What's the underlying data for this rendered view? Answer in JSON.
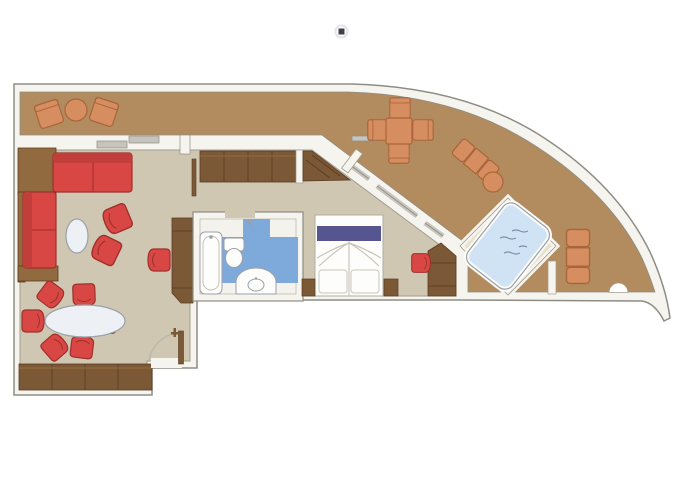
{
  "plan": {
    "kind": "suite-floor-plan",
    "rooms": [
      "balcony-deck",
      "living-room",
      "dining-area",
      "corridor",
      "bathroom",
      "bedroom",
      "whirlpool-deck"
    ],
    "items": [
      "sectional-sofa",
      "coffee-table",
      "armchair",
      "dining-table",
      "dining-chair",
      "sideboard",
      "tv-cabinet",
      "wardrobe-closet",
      "bathtub",
      "toilet",
      "sink-vanity",
      "shower-head",
      "double-bed",
      "nightstand",
      "desk",
      "desk-chair",
      "deck-chair",
      "deck-table",
      "sun-lounger",
      "side-table",
      "whirlpool-tub",
      "entrance-door",
      "balcony-door",
      "window",
      "marker-dot"
    ]
  },
  "colors": {
    "balcony": "#b28b5e",
    "wall": "#f6f4ee",
    "wall_stroke": "#8d8d85",
    "floor": "#cfc7b2",
    "floor_stroke": "#a19d8f",
    "wood": "#7b5836",
    "wood_dark": "#5a3b21",
    "wood_light": "#926a3f",
    "red": "#d94745",
    "red_dark": "#9e2f2c",
    "red_back": "#c13e3b",
    "deck": "#d68e60",
    "deck_dark": "#a9653a",
    "blue": "#7ea9db",
    "water": "#d0e3f5",
    "water_line": "#7d8fa6",
    "purple": "#575590",
    "fixture": "#fdfdfb",
    "fixture_stroke": "#9aa0a8",
    "table": "#edf1f6",
    "platform": "#e8e1ce",
    "glass": "#c6c4bc",
    "arc": "#b9b5a9",
    "linen": "#c9c6ba",
    "marker": "#3f3f4a"
  }
}
